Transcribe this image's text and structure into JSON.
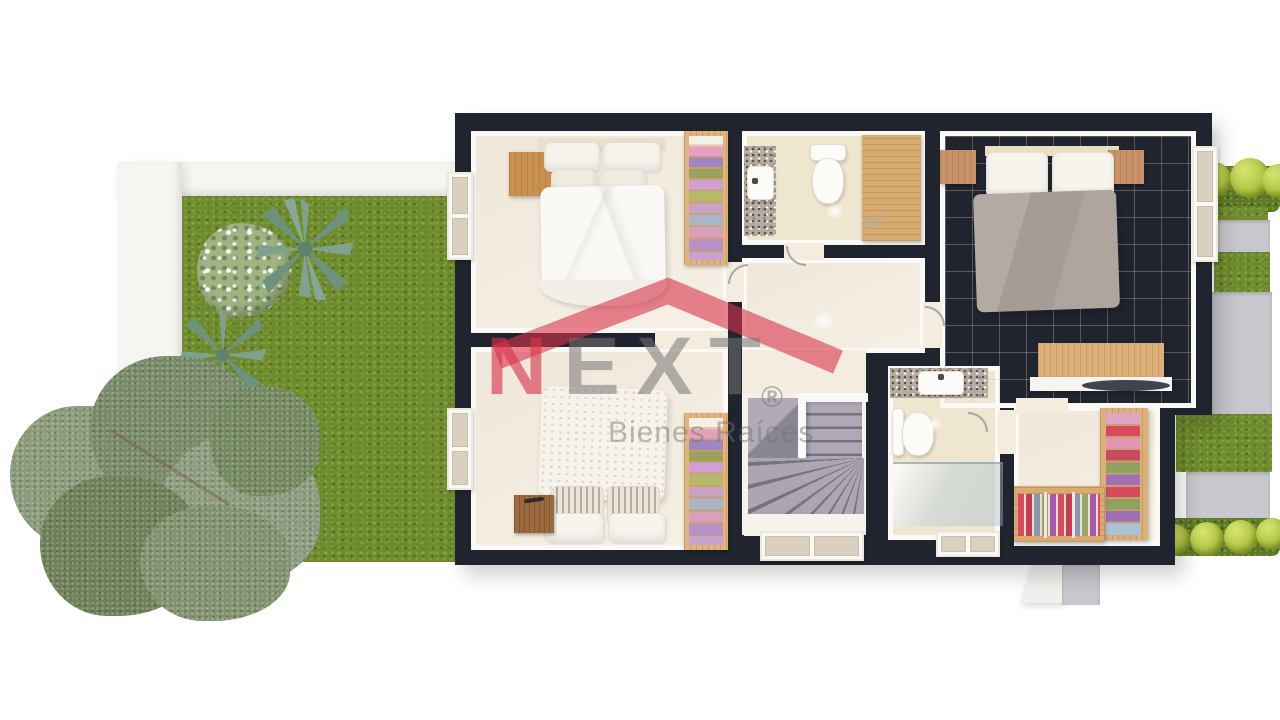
{
  "watermark": {
    "brand": "NEXT",
    "brand_letters": {
      "n": "N",
      "e": "E",
      "x": "X",
      "t": "T"
    },
    "registered": "®",
    "tagline": "Bienes Raíces",
    "brand_red": "#D8344B",
    "brand_gray": "#747474"
  },
  "palette": {
    "background": "#FFFFFF",
    "wall_dark": "#20242F",
    "floor_cream": "#F4EDE2",
    "floor_beige": "#EFE6D0",
    "lawn_green": "#6E8B2F",
    "hedge_green": "#5E7A26",
    "shrub_green": "#AEC23E",
    "concrete_gray": "#C7C7CD",
    "wood_light": "#DCB079",
    "wood_mid": "#C8914F",
    "wood_dark": "#9C6A3E",
    "bed_gray": "#AAA39C",
    "stair_gray": "#938E9A",
    "granite": "#B8ABA1",
    "tree_green": "#8B9B7C"
  }
}
